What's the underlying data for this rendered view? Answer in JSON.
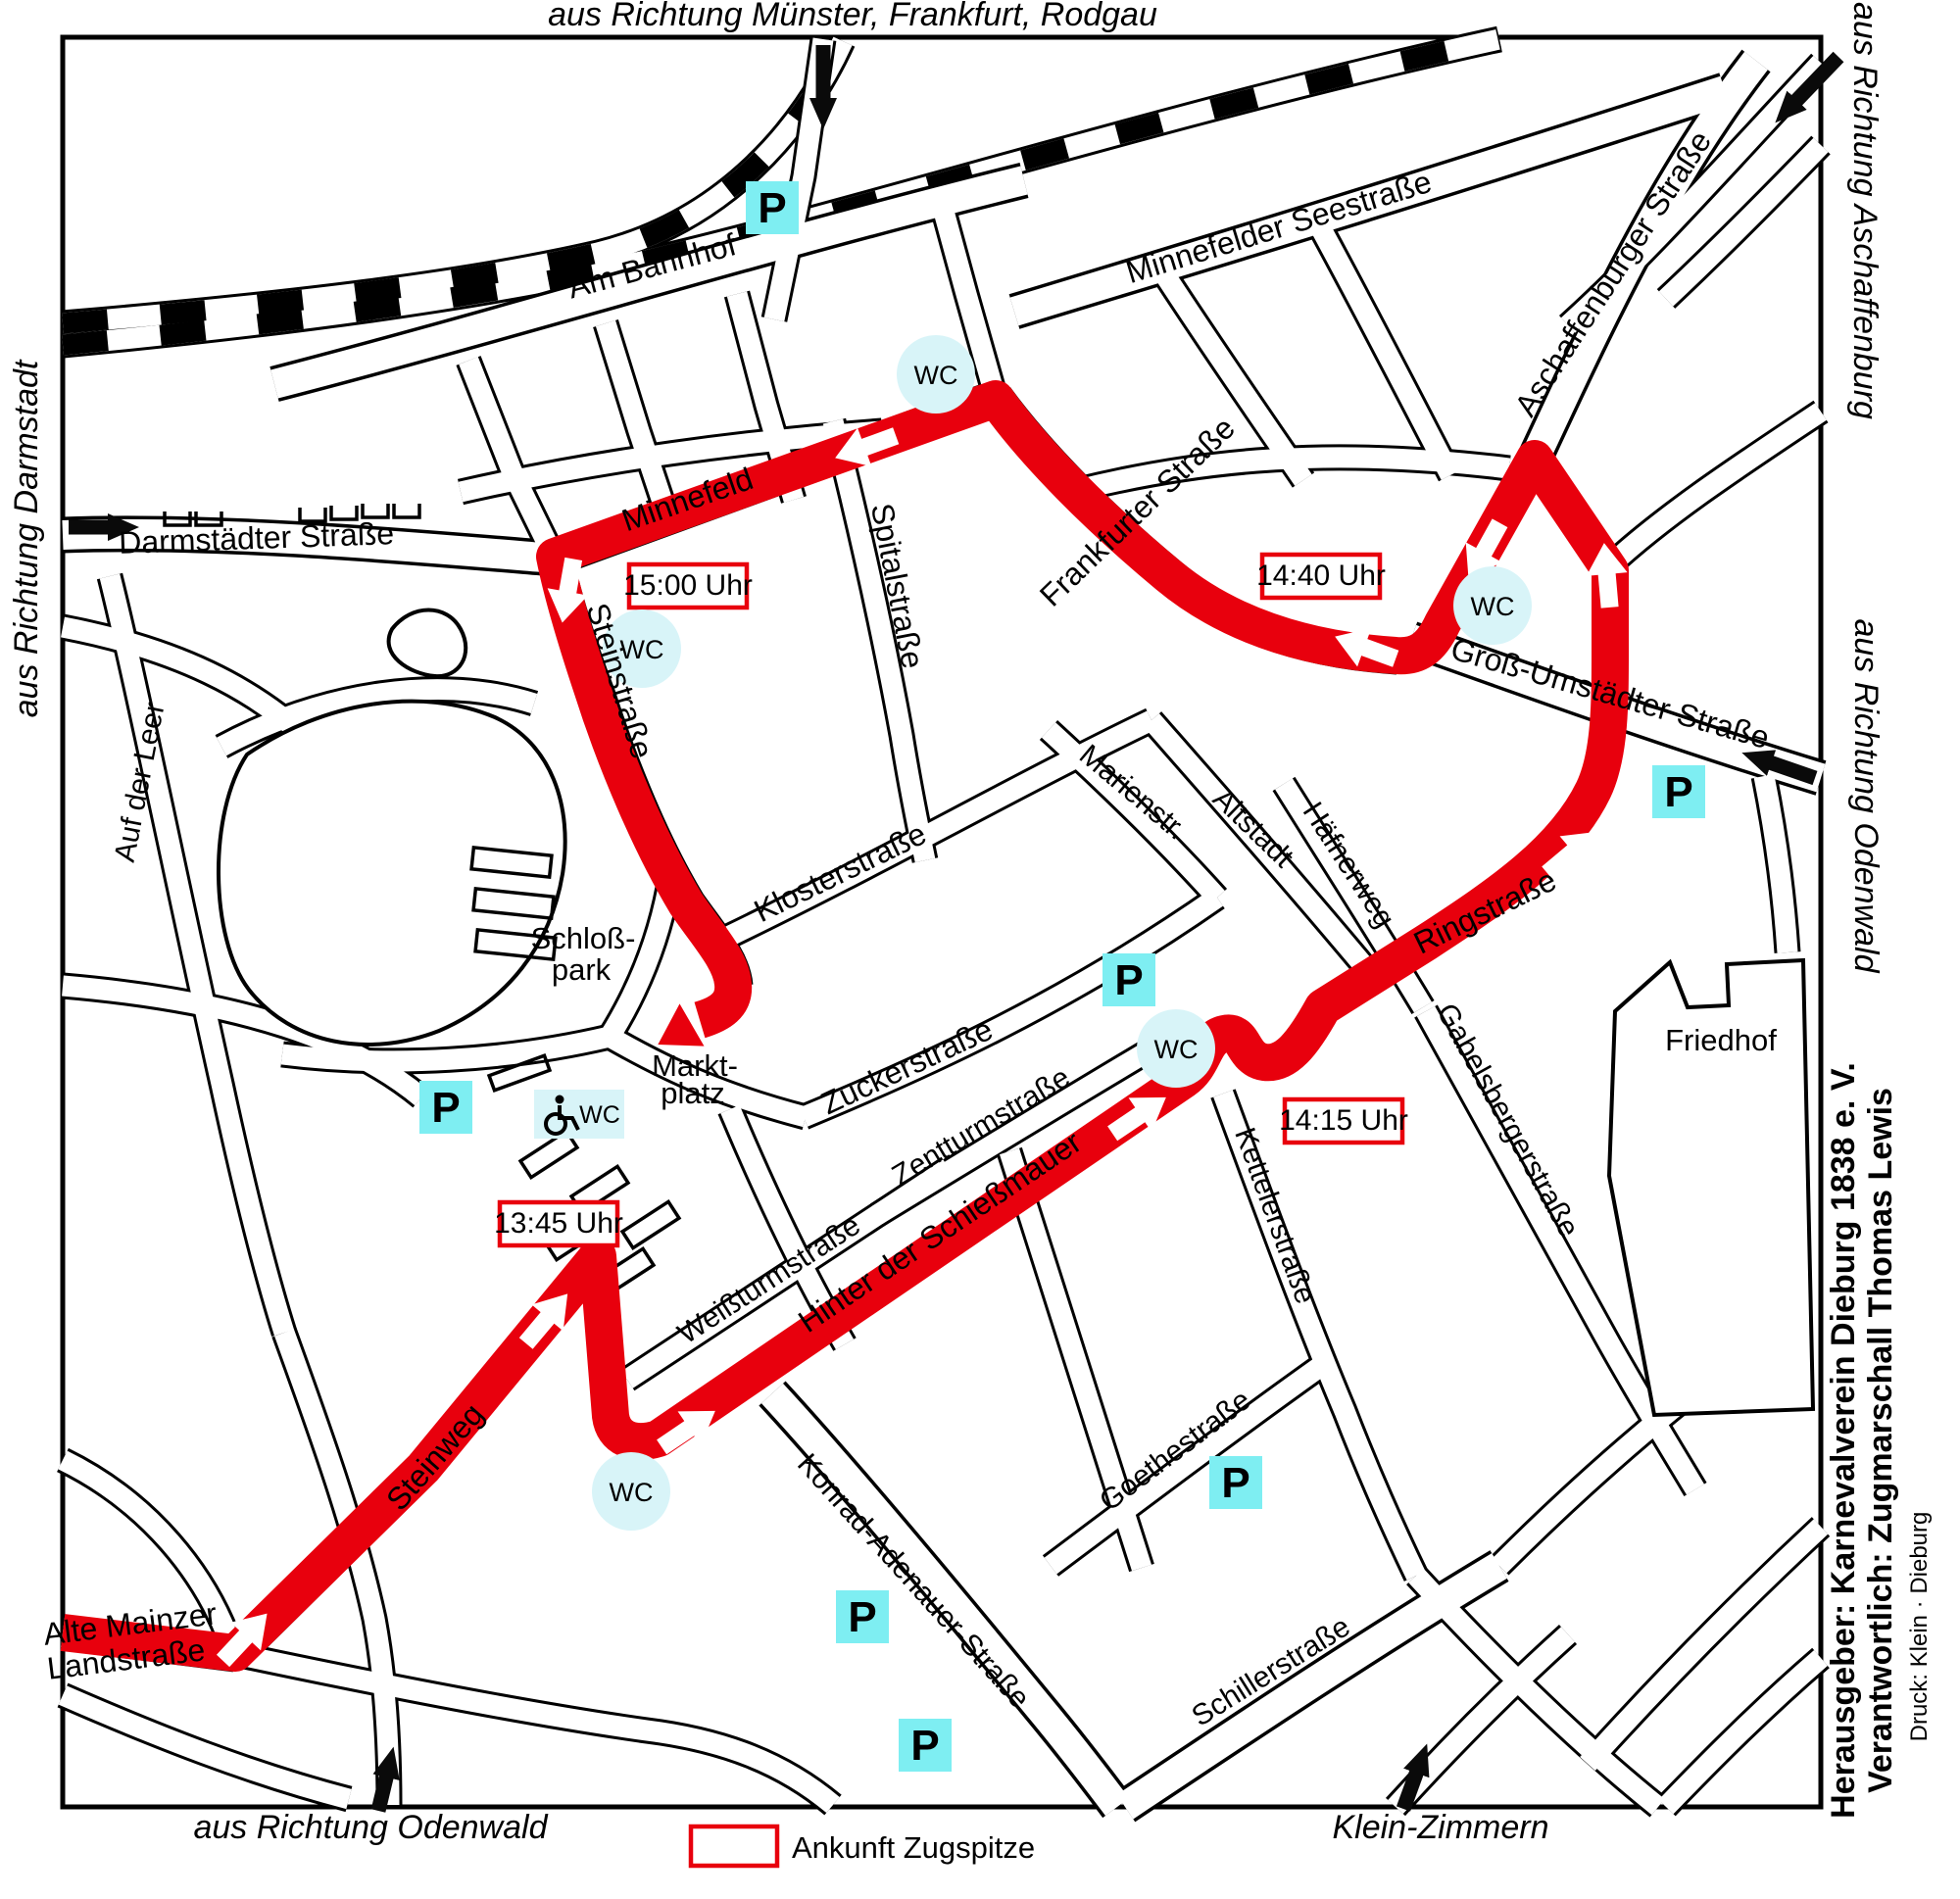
{
  "directions": {
    "muenster": "aus Richtung Münster, Frankfurt, Rodgau",
    "aschaffenburg": "aus Richtung Aschaffenburg",
    "odenwald_east": "aus Richtung Odenwald",
    "darmstadt": "aus Richtung Darmstadt",
    "odenwald_south": "aus Richtung Odenwald",
    "klein_zimmern": "Klein-Zimmern"
  },
  "streets": {
    "am_bahnhof": "Am Bahnhof",
    "minnefelder_seestrasse": "Minnefelder Seestraße",
    "darmstaedter_strasse": "Darmstädter Straße",
    "auf_der_leer": "Auf der Leer",
    "aschaffenburger_strasse": "Aschaffenburger Straße",
    "frankfurter_strasse": "Frankfurter Straße",
    "minnefeld": "Minnefeld",
    "steinstrasse": "Steinstraße",
    "spitalstrasse": "Spitalstraße",
    "klosterstrasse": "Klosterstraße",
    "marienstrasse": "Marienstr.",
    "altstadt": "Altstadt",
    "haefnerweg": "Häfnerweg",
    "gross_umstaedter_strasse": "Groß-Umstädter Straße",
    "ringstrasse": "Ringstraße",
    "gabelsbergerstrasse": "Gabelsbergerstraße",
    "kettelerstrasse": "Kettelerstraße",
    "zuckerstrasse": "Zuckerstraße",
    "zentturmstrasse": "Zentturmstraße",
    "weissturmstrasse": "Weißturmstraße",
    "hinter_der_schiessmauer": "Hinter der Schießmauer",
    "steinweg": "Steinweg",
    "alte_mainzer_line1": "Alte Mainzer",
    "alte_mainzer_line2": "Landstraße",
    "konrad_adenauer_strasse": "Konrad-Adenauer-Straße",
    "goethestrasse": "Goethestraße",
    "schillerstrasse": "Schillerstraße"
  },
  "places": {
    "schlosspark_line1": "Schloß-",
    "schlosspark_line2": "park",
    "marktplatz_line1": "Markt-",
    "marktplatz_line2": "platz",
    "friedhof": "Friedhof"
  },
  "route_times": {
    "t1345": "13:45 Uhr",
    "t1415": "14:15 Uhr",
    "t1440": "14:40 Uhr",
    "t1500": "15:00 Uhr"
  },
  "markers": {
    "parking": "P",
    "wc": "WC"
  },
  "legend": {
    "arrival": "Ankunft Zugspitze"
  },
  "credits": {
    "publisher": "Herausgeber: Karnevalverein Dieburg 1838 e. V.",
    "responsible": "Verantwortlich: Zugmarschall Thomas Lewis",
    "print": "Druck: Klein · Dieburg"
  },
  "colors": {
    "route": "#e8000d",
    "time_box_border": "#e8000d",
    "legend_border": "#e8000d",
    "parking_fill": "#7eeef2",
    "wc_fill": "#d8f4f8"
  }
}
